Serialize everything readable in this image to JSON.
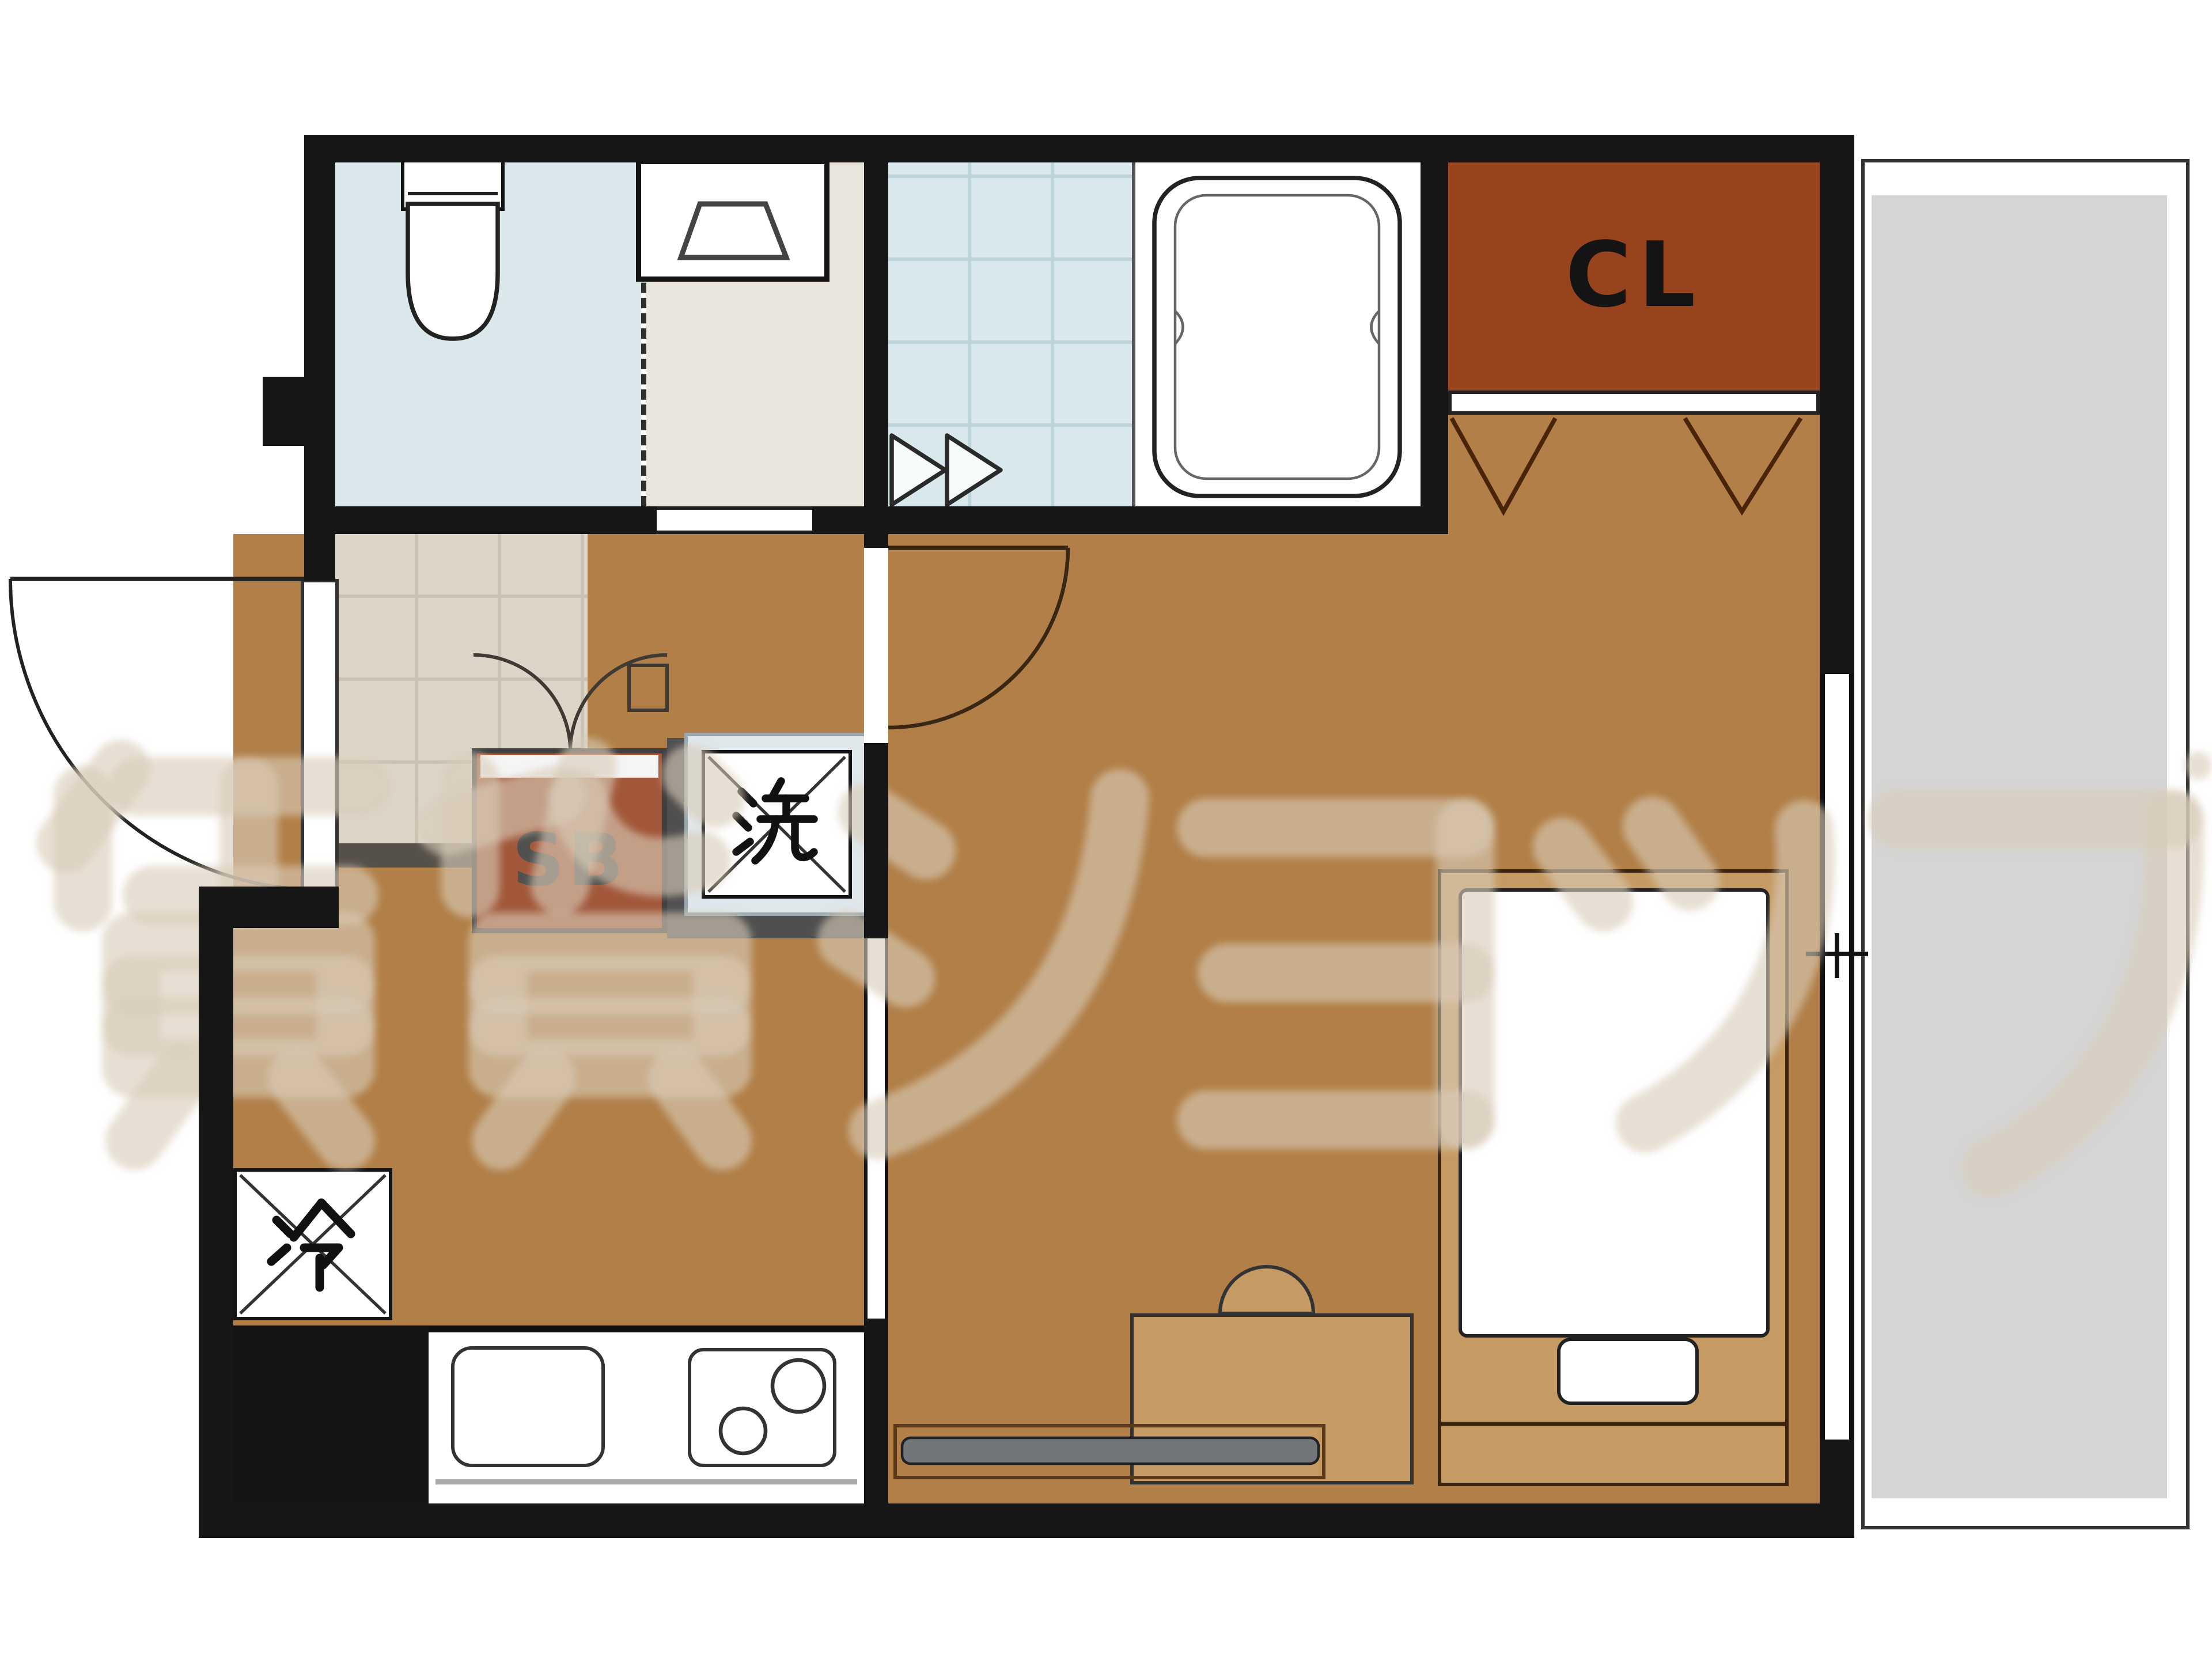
{
  "floorplan": {
    "type": "apartment-room-layout",
    "labels": {
      "closet": "CL",
      "shoe_box": "SB",
      "washing_machine": "洗",
      "refrigerator": "冷"
    },
    "watermark": {
      "text": "賃貸ショップ"
    },
    "fixtures": [
      "toilet",
      "washing-machine-pan",
      "bathtub",
      "closet-bifold-doors",
      "entrance-door",
      "room-door",
      "double-doors",
      "folding-bath-door",
      "kitchen-sink",
      "two-burner-stove",
      "refrigerator-space",
      "washing-machine-space",
      "shoe-box",
      "bed",
      "desk-with-chair",
      "tv-board",
      "sliding-window",
      "balcony"
    ],
    "colors": {
      "wall": "#161616",
      "wood_floor": "#b17f47",
      "toilet_floor": "#dae8ec",
      "bath_tile": "#d8e8ec",
      "washroom_floor": "#eae6dd",
      "genkan_tile": "#dcd6c9",
      "closet_fill": "#97431e",
      "shoebox_fill": "#a2573a",
      "balcony": "#d5d5d5",
      "furniture_tan": "#c59a63",
      "watermark": "#d8ccb8"
    }
  }
}
